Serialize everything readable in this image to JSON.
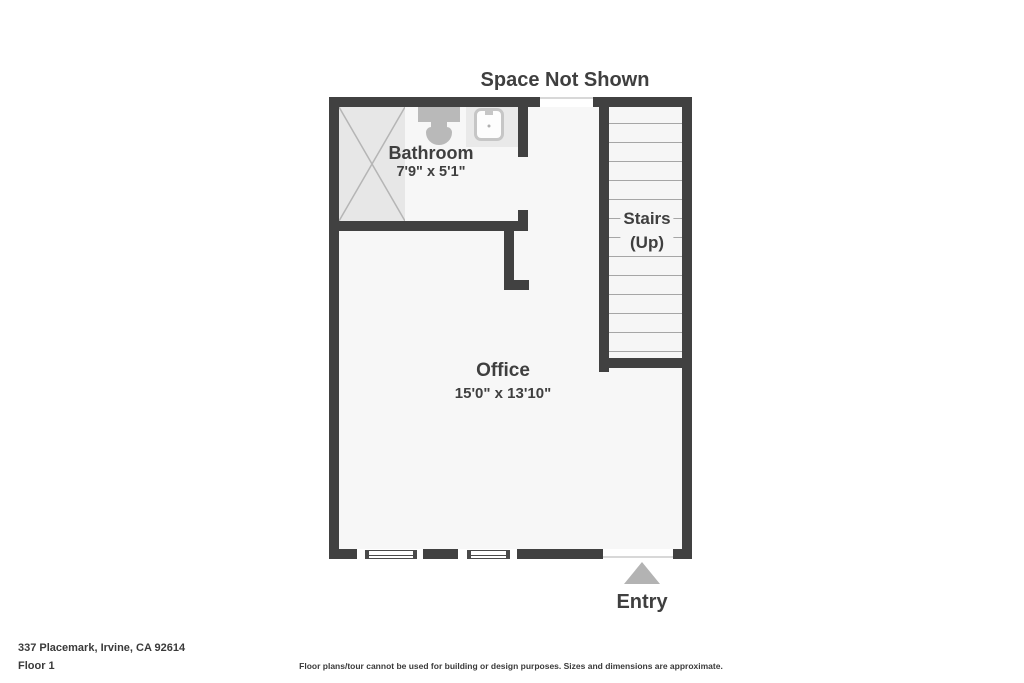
{
  "plan": {
    "space_label": "Space Not Shown",
    "bathroom": {
      "name": "Bathroom",
      "dimensions": "7'9\" x 5'1\""
    },
    "office": {
      "name": "Office",
      "dimensions": "15'0\" x 13'10\""
    },
    "stairs": {
      "name": "Stairs",
      "direction": "(Up)",
      "tread_count": 13
    },
    "entry_label": "Entry"
  },
  "footer": {
    "address": "337 Placemark, Irvine, CA 92614",
    "floor": "Floor 1",
    "disclaimer": "Floor plans/tour cannot be used for building or design purposes. Sizes and dimensions are approximate."
  },
  "colors": {
    "wall": "#414141",
    "interior": "#f7f7f7",
    "stair_fill": "#f6f6f6",
    "tread_line": "#a6a6a6",
    "shower_fill": "#e7e7e7",
    "shower_line": "#b5b5b5",
    "fixture": "#b9b9b9",
    "vanity_fill": "#e9e9e9",
    "entry_arrow": "#b3b3b3",
    "text": "#3f3f3f",
    "threshold": "#d8d8d8"
  }
}
